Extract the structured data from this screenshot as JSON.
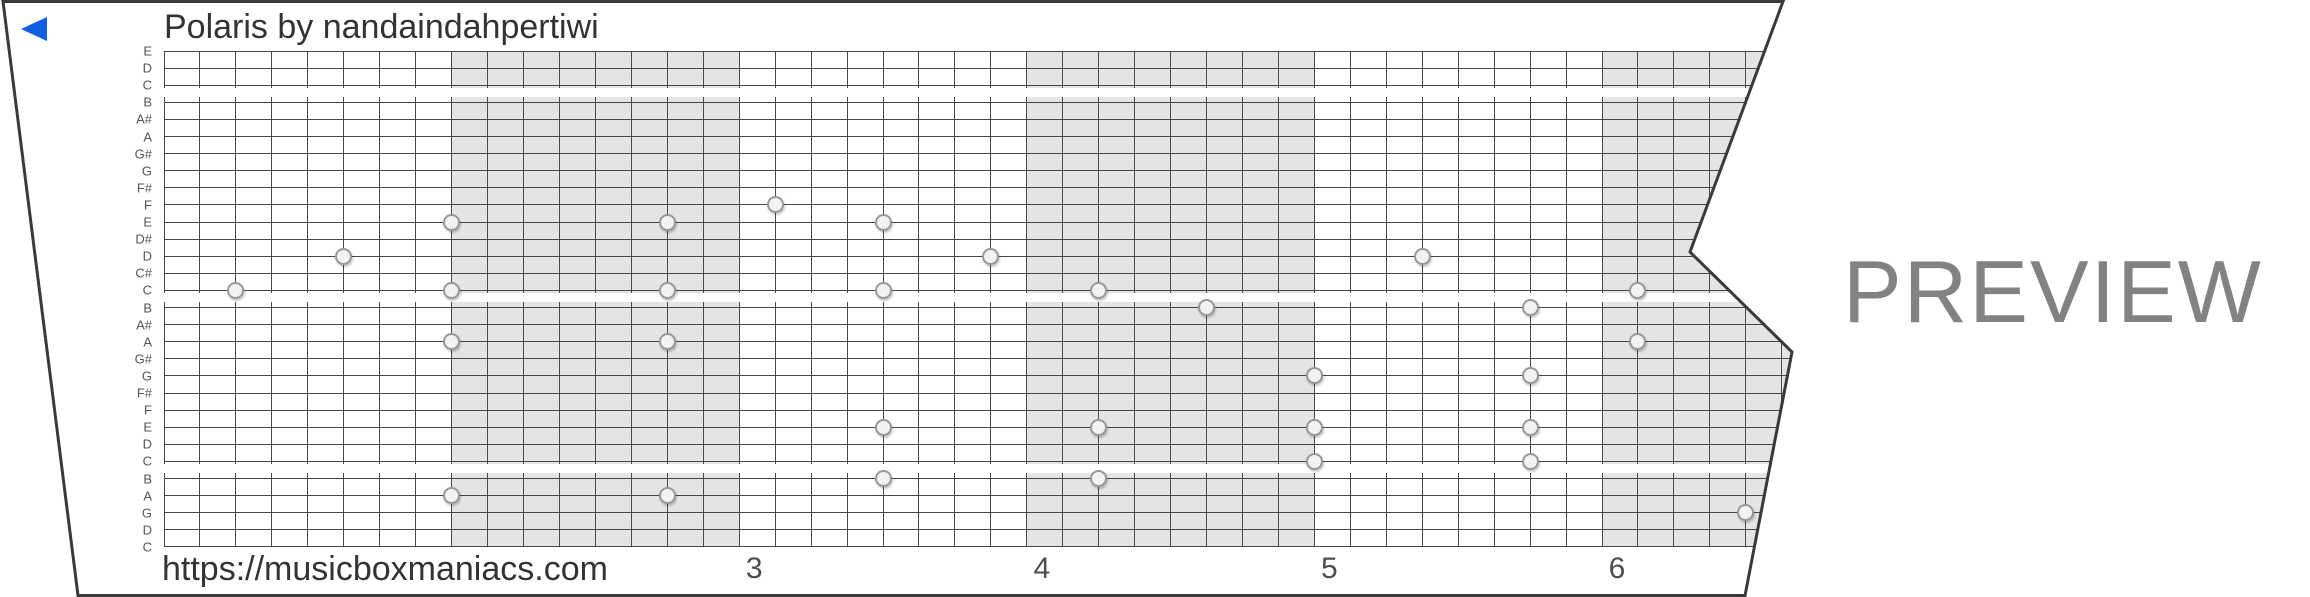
{
  "strip": {
    "title": "Polaris by nandaindahpertiwi",
    "footer_url": "https://musicboxmaniacs.com",
    "note_labels": [
      "E",
      "D",
      "C",
      "B",
      "A#",
      "A",
      "G#",
      "G",
      "F#",
      "F",
      "E",
      "D#",
      "D",
      "C#",
      "C",
      "B",
      "A#",
      "A",
      "G#",
      "G",
      "F#",
      "F",
      "E",
      "D",
      "C",
      "B",
      "A",
      "G",
      "D",
      "C"
    ],
    "measure_numbers": [
      {
        "label": "3",
        "measure_index": 2
      },
      {
        "label": "4",
        "measure_index": 3
      },
      {
        "label": "5",
        "measure_index": 4
      },
      {
        "label": "6",
        "measure_index": 5
      }
    ],
    "shaded_measure_indices": [
      1,
      3,
      5
    ],
    "notes": [
      {
        "col": 2,
        "row": 14,
        "pitch": "C5"
      },
      {
        "col": 5,
        "row": 12,
        "pitch": "D5"
      },
      {
        "col": 8,
        "row": 10,
        "pitch": "E5"
      },
      {
        "col": 8,
        "row": 14,
        "pitch": "C5"
      },
      {
        "col": 8,
        "row": 17,
        "pitch": "A4"
      },
      {
        "col": 8,
        "row": 26,
        "pitch": "A3"
      },
      {
        "col": 14,
        "row": 10,
        "pitch": "E5"
      },
      {
        "col": 14,
        "row": 14,
        "pitch": "C5"
      },
      {
        "col": 14,
        "row": 17,
        "pitch": "A4"
      },
      {
        "col": 14,
        "row": 26,
        "pitch": "A3"
      },
      {
        "col": 17,
        "row": 9,
        "pitch": "F5"
      },
      {
        "col": 20,
        "row": 10,
        "pitch": "E5"
      },
      {
        "col": 20,
        "row": 14,
        "pitch": "C5"
      },
      {
        "col": 20,
        "row": 22,
        "pitch": "E4"
      },
      {
        "col": 20,
        "row": 25,
        "pitch": "B3"
      },
      {
        "col": 23,
        "row": 12,
        "pitch": "D5"
      },
      {
        "col": 26,
        "row": 14,
        "pitch": "C5"
      },
      {
        "col": 26,
        "row": 22,
        "pitch": "E4"
      },
      {
        "col": 26,
        "row": 25,
        "pitch": "B3"
      },
      {
        "col": 29,
        "row": 15,
        "pitch": "B4"
      },
      {
        "col": 32,
        "row": 19,
        "pitch": "G4"
      },
      {
        "col": 32,
        "row": 22,
        "pitch": "E4"
      },
      {
        "col": 32,
        "row": 24,
        "pitch": "C4"
      },
      {
        "col": 35,
        "row": 12,
        "pitch": "D5"
      },
      {
        "col": 38,
        "row": 15,
        "pitch": "B4"
      },
      {
        "col": 38,
        "row": 19,
        "pitch": "G4"
      },
      {
        "col": 38,
        "row": 22,
        "pitch": "E4"
      },
      {
        "col": 38,
        "row": 24,
        "pitch": "C4"
      },
      {
        "col": 41,
        "row": 14,
        "pitch": "C5"
      },
      {
        "col": 41,
        "row": 17,
        "pitch": "A4"
      },
      {
        "col": 44,
        "row": 27,
        "pitch": "G3"
      }
    ],
    "colors": {
      "shaded_band": "#e4e4e4",
      "grid_line": "#454545",
      "paper_edge": "#3a3a3a",
      "play_blue": "#0f5fe0",
      "watermark_gray": "#828282"
    }
  },
  "watermark": {
    "label": "PREVIEW"
  },
  "icons": {
    "play": "left-pointing-triangle"
  }
}
